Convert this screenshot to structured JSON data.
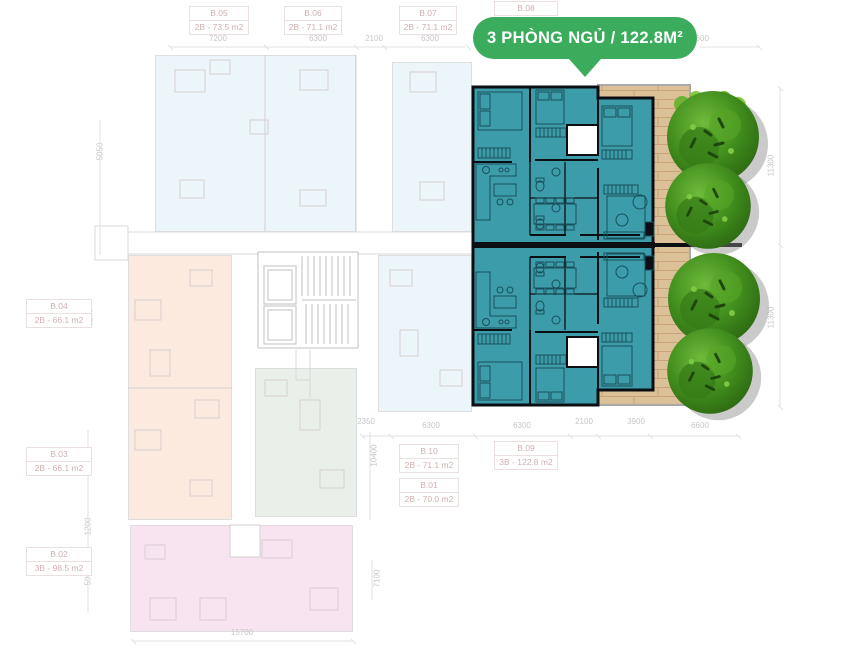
{
  "badge": {
    "label": "3 PHÒNG NGỦ / 122.8M²",
    "color": "#3BAC5C"
  },
  "units": [
    {
      "id": "B.05",
      "size": "2B - 73.5 m2"
    },
    {
      "id": "B.06",
      "size": "2B - 71.1 m2"
    },
    {
      "id": "B.07",
      "size": "2B - 71.1 m2"
    },
    {
      "id": "B.08"
    },
    {
      "id": "B.04",
      "size": "2B - 66.1 m2"
    },
    {
      "id": "B.03",
      "size": "2B - 66.1 m2"
    },
    {
      "id": "B.02",
      "size": "3B - 98.5 m2"
    },
    {
      "id": "B.10",
      "size": "2B - 71.1 m2"
    },
    {
      "id": "B.09",
      "size": "3B - 122.8 m2"
    },
    {
      "id": "B.01",
      "size": "2B - 70.0 m2"
    }
  ],
  "dims": {
    "top": [
      "7200",
      "6300",
      "2100",
      "6300",
      "6600"
    ],
    "bottom": [
      "2350",
      "6300",
      "6300",
      "2100",
      "3900",
      "6600"
    ],
    "total_bottom": "15700",
    "left": [
      "5050",
      "2000",
      "6200",
      "9200",
      "1200",
      "5900"
    ],
    "right": [
      "11300",
      "11300"
    ],
    "inner": [
      "10400",
      "7100"
    ]
  },
  "colors": {
    "highlight_teal": "#3D9CAA",
    "wall_black": "#0B0F14",
    "badge_green": "#3BAC5C",
    "deck_wood": "#DCC097",
    "tree_green": "#3F8C1C",
    "tint_blue": "#ECF5FA",
    "tint_peach": "#FBEADD",
    "tint_green": "#E9F0E9",
    "tint_pink": "#F8E3F1"
  }
}
